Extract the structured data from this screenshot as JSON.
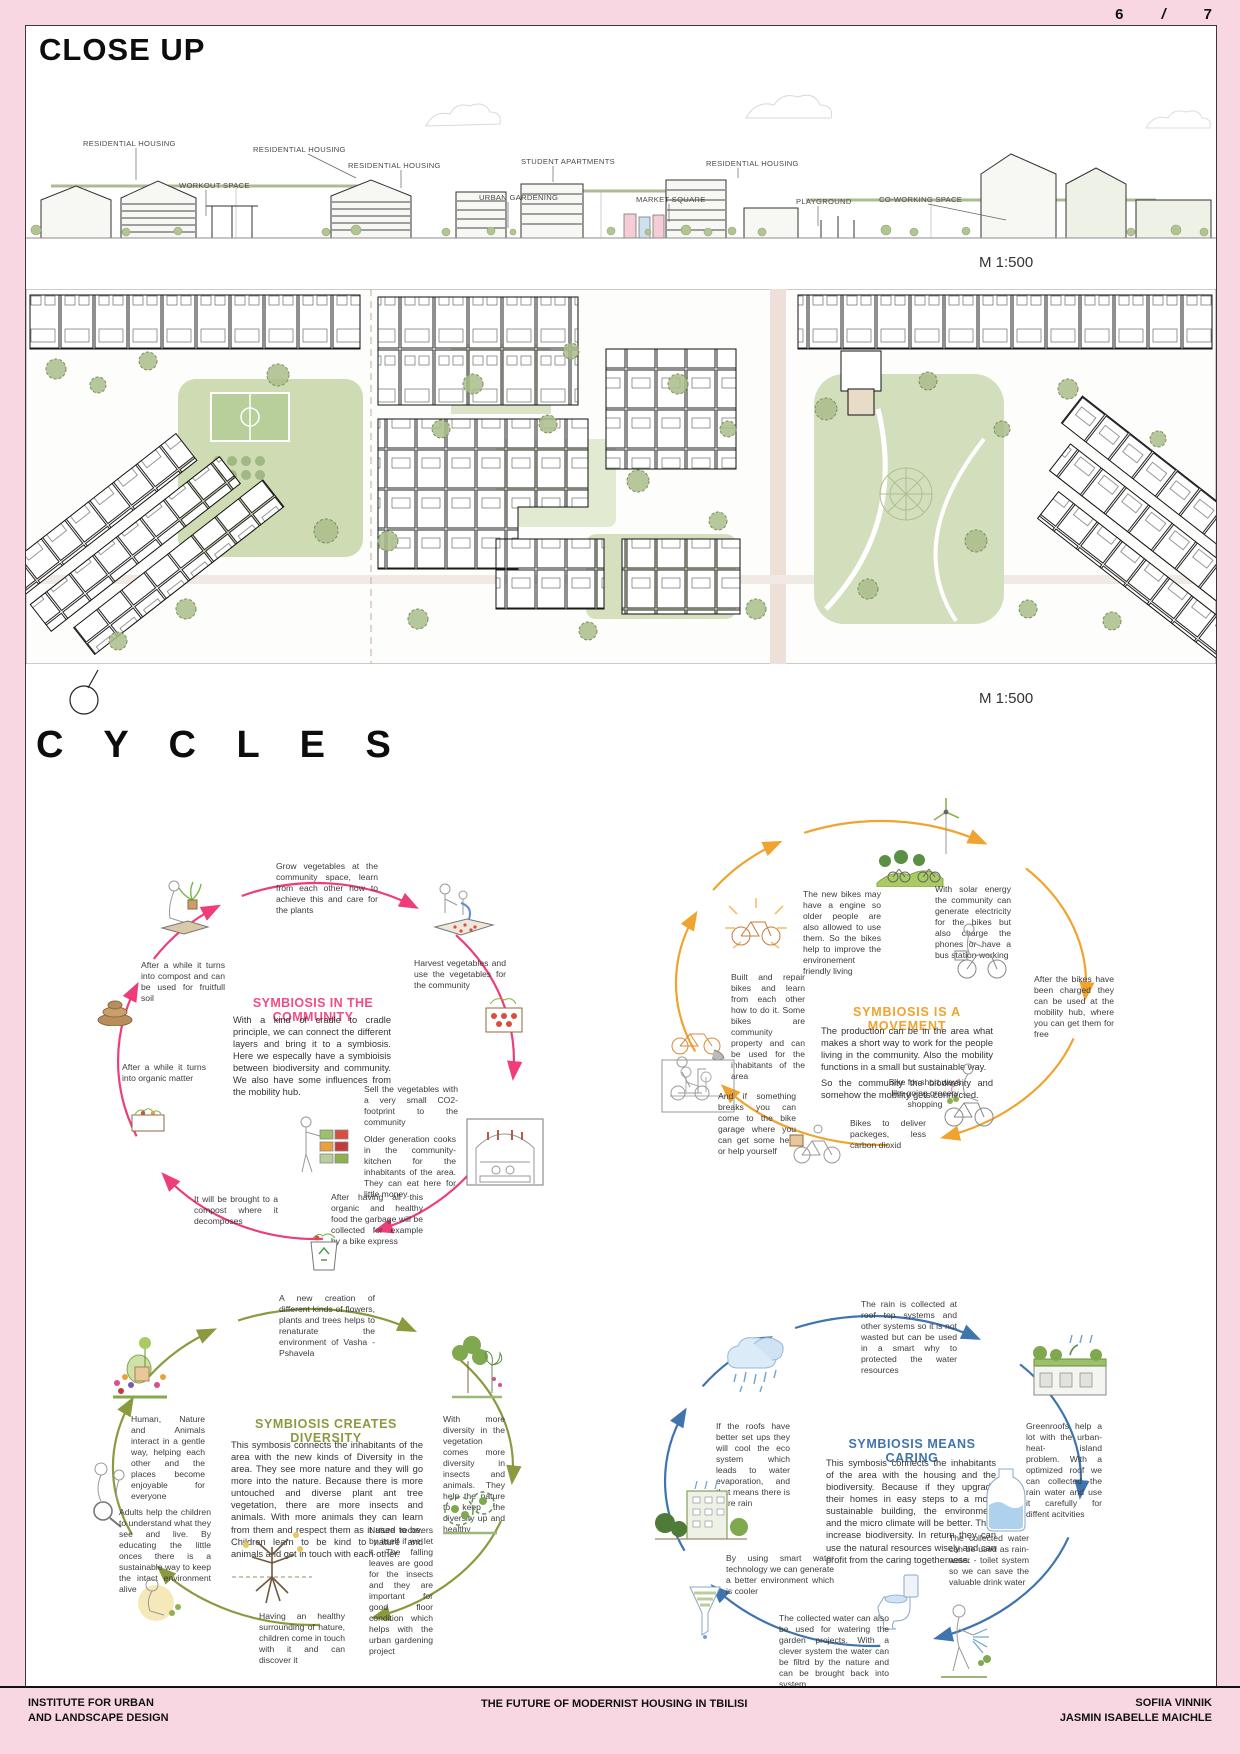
{
  "page": {
    "numbers": {
      "left": "6",
      "sep": "/",
      "right": "7"
    },
    "bg_pink": "#f8d7e3"
  },
  "header": {
    "title": "CLOSE UP"
  },
  "elevation": {
    "labels": [
      "RESIDENTIAL HOUSING",
      "WORKOUT SPACE",
      "RESIDENTIAL HOUSING",
      "RESIDENTIAL HOUSING",
      "URBAN GARDENING",
      "STUDENT APARTMENTS",
      "MARKET SQUARE",
      "RESIDENTIAL HOUSING",
      "PLAYGROUND",
      "CO-WORKING SPACE"
    ],
    "scale": "M 1:500"
  },
  "siteplan": {
    "scale": "M 1:500"
  },
  "cycles_heading": "C Y C L E S",
  "colors": {
    "pink": "#ee3d77",
    "orange": "#f0a32e",
    "green": "#8a9a3f",
    "blue": "#3f74ae"
  },
  "cycles": [
    {
      "title": "SYMBIOSIS IN THE COMMUNITY",
      "body": "With a kind of cradle to cradle principle, we can connect the different layers and bring it to a symbiosis. Here we especally have a symbioisis between biodiversity and community.  We also have some influences from the mobility hub.",
      "nodes": [
        {
          "text": "Grow vegetables at the community space, learn from each other how to achieve this and care for the plants"
        },
        {
          "text": "Harvest vegetables and use the vegetables for the community"
        },
        {
          "text": "Sell the vegetables with a very small CO2- footprint to the community"
        },
        {
          "text": "Older generation cooks in the community-kitchen for the inhabitants of the area. They can eat here for little money."
        },
        {
          "text": "After having all this organic and healthy food the garbage will be collected for example by a bike express"
        },
        {
          "text": "It will be brought to a compost where it decomposes"
        },
        {
          "text": "After a while it turns into organic matter"
        },
        {
          "text": "After a while it turns into compost and can be used for fruitfull soil"
        }
      ]
    },
    {
      "title": "SYMBIOSIS IS A MOVEMENT",
      "body": "The production can be in the area what makes a short way to work for the people living in the community. Also the mobility functions in a small but sustainable way.",
      "body2": "So the community the biodiverity and somehow the mobility gets connected.",
      "nodes": [
        {
          "text": "The new bikes may have a engine so older people are also allowed to use them. So the bikes help to improve the environement friendly living"
        },
        {
          "text": "With solar energy the community can generate electricity for the bikes but also charge the phones or have a bus station working"
        },
        {
          "text": "After the bikes have been charged they can be used at the mobility hub, where you can get them for free"
        },
        {
          "text": "Bike for short ways like going grocery shopping"
        },
        {
          "text": "Bikes to deliver packeges, less carbon dioxid"
        },
        {
          "text": "And if something breaks you can come to the bike garage where you can get some help or help yourself"
        },
        {
          "text": "Built and repair bikes and learn from each other how to do it. Some bikes are community property and can be used for the inhabitants of the area"
        }
      ]
    },
    {
      "title": "SYMBIOSIS CREATES DIVERSITY",
      "body": "This symbosis connects the inhabitants of the area with the new kinds of Diversity in the area. They see more nature and they will go more into the nature. Because there is more untouched and diverse plant ant tree vegetation, there are more insects and animals. With more animals they can learn from them and respect them as it used to be. Children learn to be kind to nature and animals and get in touch with each other.",
      "nodes": [
        {
          "text": "A new creation of different kinds of flowers, plants and trees helps to renaturate the environment of Vasha - Pshavela"
        },
        {
          "text": "With more diversity in the vegetation comes more diversity in insects and animals. They help the nature to keep the diversity up and healthy"
        },
        {
          "text": "Nature recovers by itself if we let it. The falling leaves are good for the insects and they are important for good floor condition which helps with the urban gardening project"
        },
        {
          "text": "Having an healthy surrounding of nature, children come in touch with it and can discover it"
        },
        {
          "text": "Adults help the children to understand what they see and live. By educating the little onces there is a sustainable way to keep the intact environment alive"
        },
        {
          "text": "Human, Nature and Animals interact in a gentle way, helping each other and the places become enjoyable for everyone"
        }
      ]
    },
    {
      "title": "SYMBIOSIS MEANS CARING",
      "body": "This symbosis connects the inhabitants of the area with the housing and the biodiversity. Because if they upgrade their homes in easy steps to a more sustainable building, the environment and the micro climate will be better. They increase biodiversity. In return they can use the natural resources wisely and can profit from the caring togetherness.",
      "nodes": [
        {
          "text": "The rain is collected at roof top systems and other systems so it is not wasted but can be used in a smart why to protected the water resources"
        },
        {
          "text": "Greenroofs help a lot with the urban- heat- island problem. With a optimized roof we can collected the rain water and use it carefully for diffent acitvities"
        },
        {
          "text": "The collected water can be used as rain- water - toilet system so we can save the valuable drink water"
        },
        {
          "text": "The collected water can also be used for watering the garden projects. With a clever system the water can be filtrd by the nature and can be brought back into system"
        },
        {
          "text": "By using smart water technology we can generate a better environment which is cooler"
        },
        {
          "text": "If the roofs have better set ups they will cool the eco system which leads to water evaporation, and that means there is more rain"
        }
      ]
    }
  ],
  "footer": {
    "left1": "INSTITUTE FOR URBAN",
    "left2": "AND LANDSCAPE DESIGN",
    "center": "THE FUTURE OF MODERNIST HOUSING IN TBILISI",
    "right1": "SOFIIA VINNIK",
    "right2": "JASMIN ISABELLE MAICHLE"
  }
}
